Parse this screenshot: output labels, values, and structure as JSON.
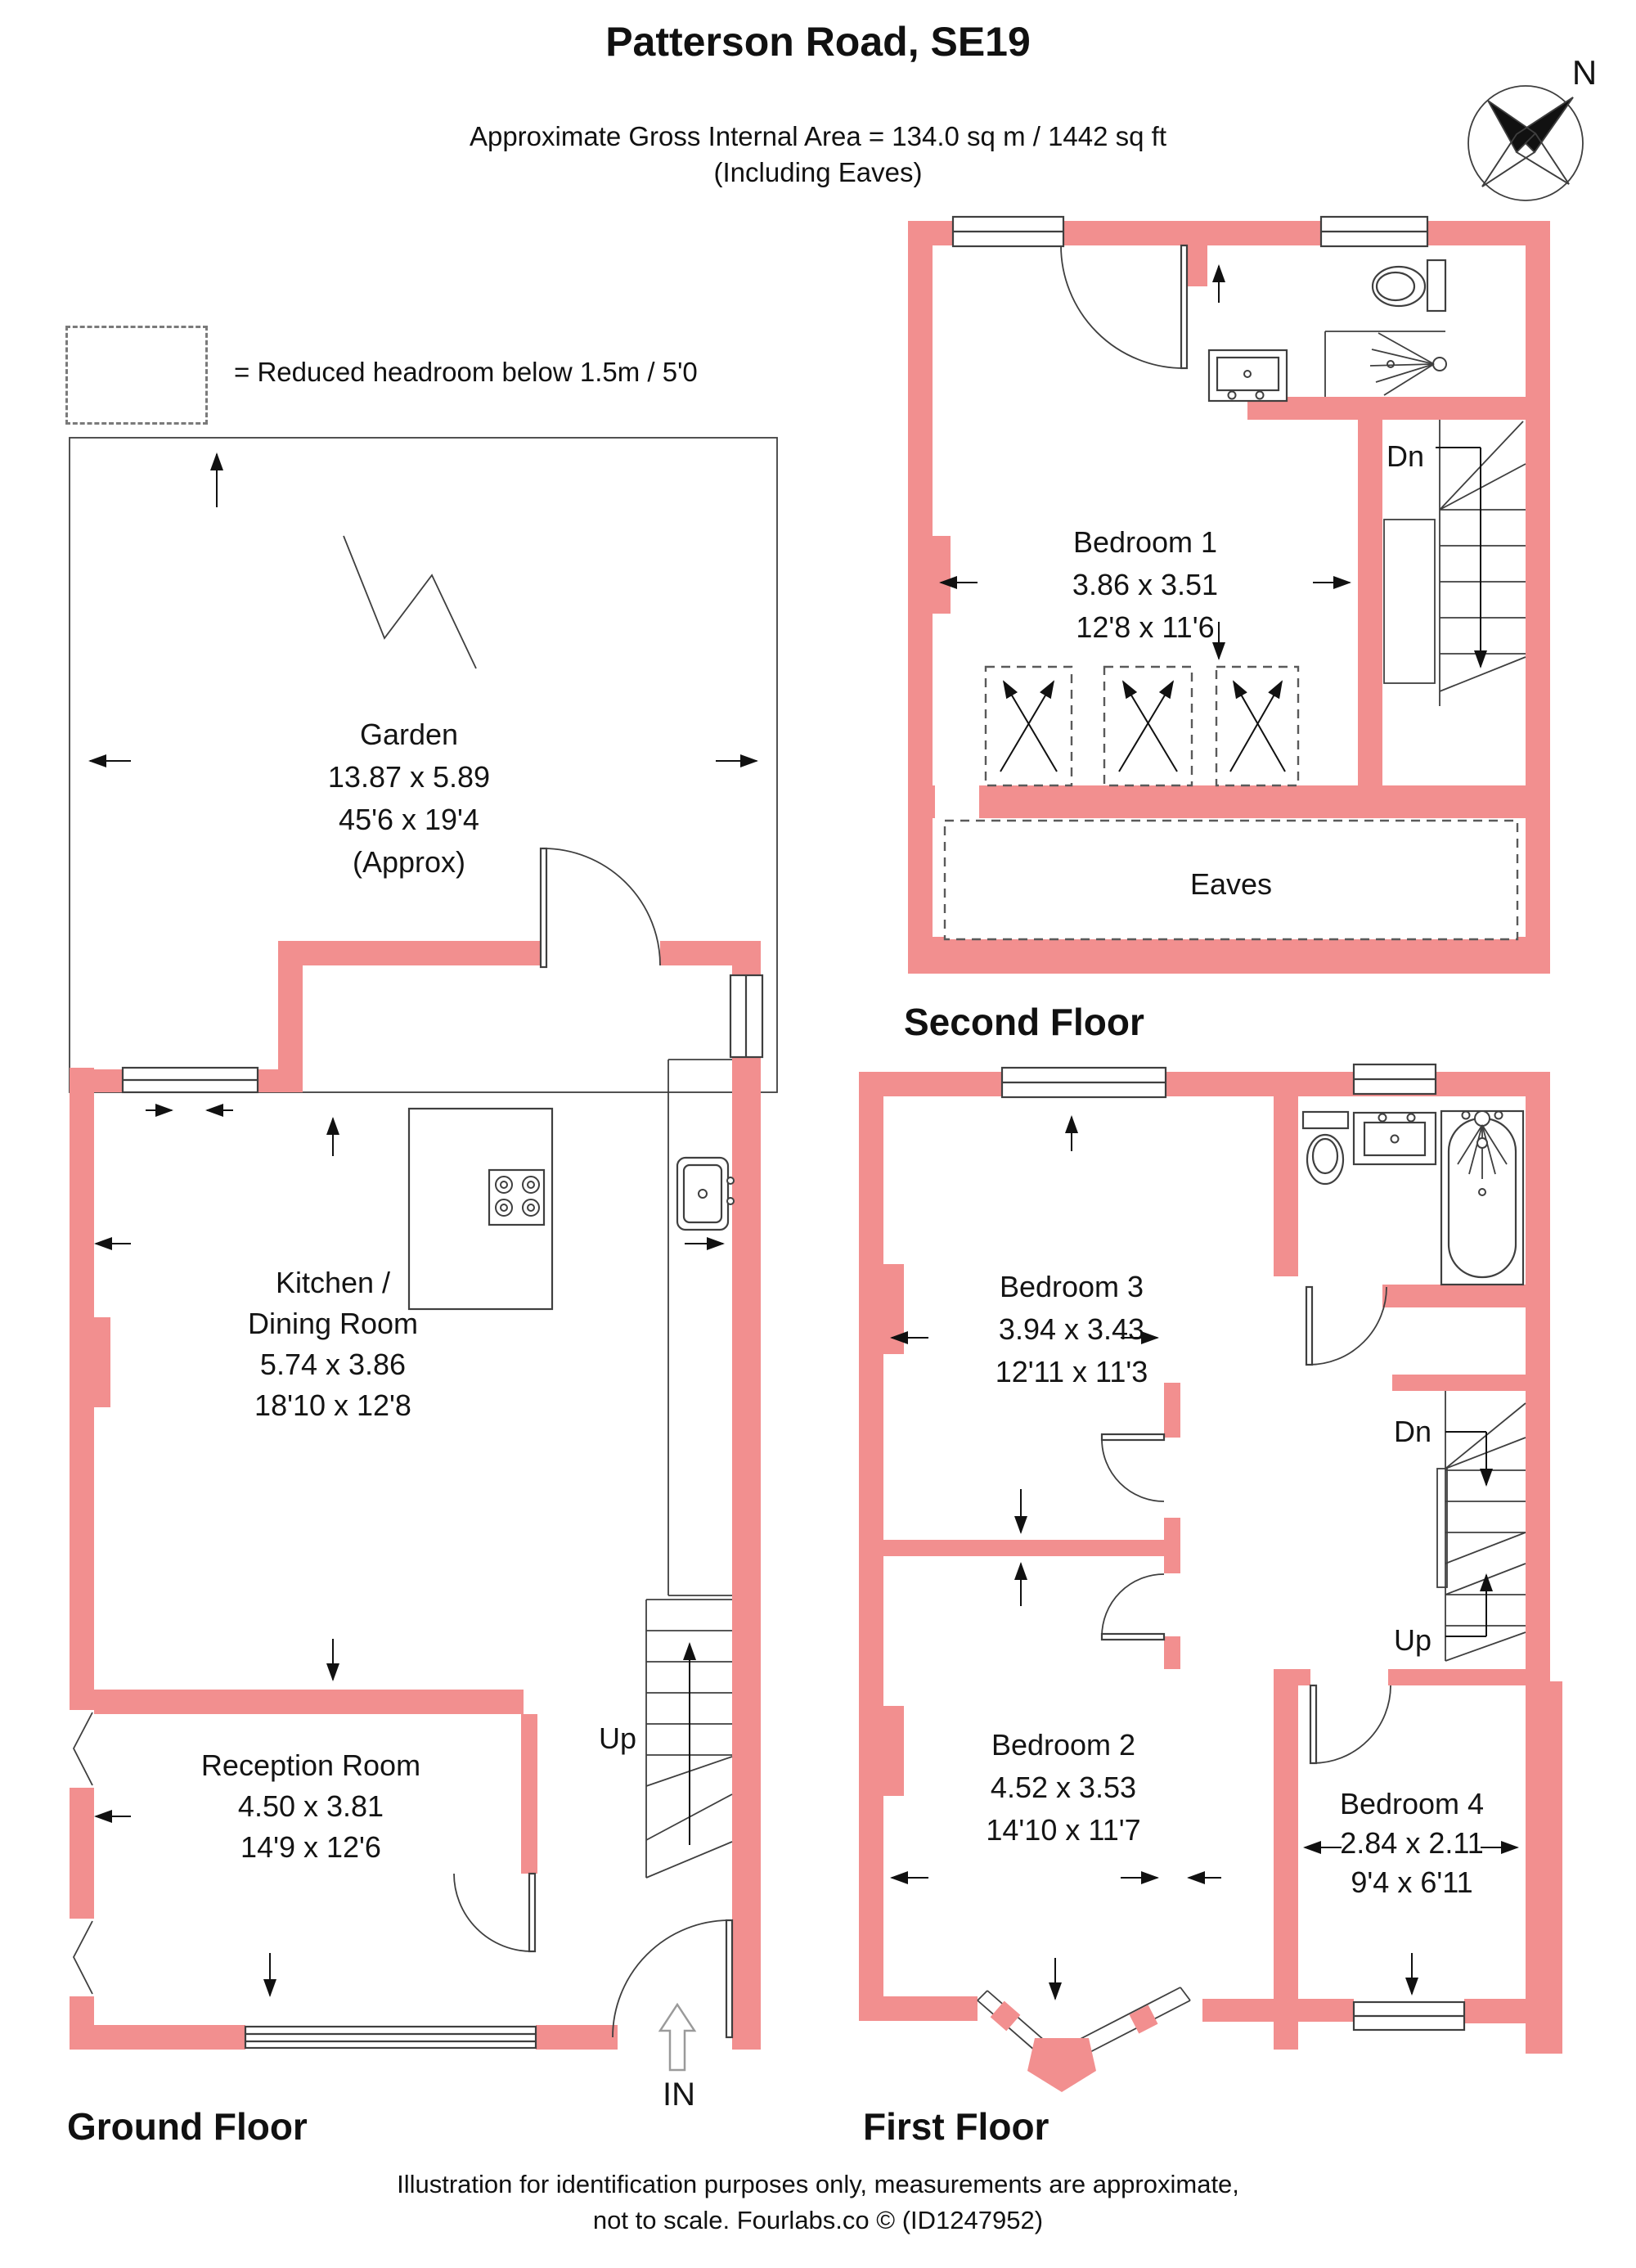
{
  "header": {
    "title": "Patterson Road, SE19",
    "area_line": "Approximate Gross Internal Area = 134.0 sq m / 1442 sq ft",
    "including_line": "(Including Eaves)",
    "compass_n": "N"
  },
  "legend": {
    "label": "= Reduced headroom below 1.5m / 5'0"
  },
  "colors": {
    "wall": "#F28F8F",
    "line": "#3F3F3F"
  },
  "ground_floor": {
    "title": "Ground Floor",
    "garden": {
      "name": "Garden",
      "dim_m": "13.87 x 5.89",
      "dim_ft": "45'6 x 19'4",
      "approx": "(Approx)"
    },
    "kitchen": {
      "name1": "Kitchen /",
      "name2": "Dining Room",
      "dim_m": "5.74 x 3.86",
      "dim_ft": "18'10 x 12'8"
    },
    "reception": {
      "name": "Reception Room",
      "dim_m": "4.50 x 3.81",
      "dim_ft": "14'9 x 12'6"
    },
    "stairs_label": "Up",
    "entrance_label": "IN"
  },
  "second_floor": {
    "title": "Second Floor",
    "bedroom1": {
      "name": "Bedroom 1",
      "dim_m": "3.86 x 3.51",
      "dim_ft": "12'8 x 11'6"
    },
    "stairs_label": "Dn",
    "eaves_label": "Eaves"
  },
  "first_floor": {
    "title": "First Floor",
    "bedroom3": {
      "name": "Bedroom 3",
      "dim_m": "3.94 x 3.43",
      "dim_ft": "12'11 x 11'3"
    },
    "bedroom2": {
      "name": "Bedroom 2",
      "dim_m": "4.52 x 3.53",
      "dim_ft": "14'10 x 11'7"
    },
    "bedroom4": {
      "name": "Bedroom 4",
      "dim_m": "2.84 x 2.11",
      "dim_ft": "9'4 x 6'11"
    },
    "stairs_down_label": "Dn",
    "stairs_up_label": "Up"
  },
  "footer": {
    "line1": "Illustration for identification purposes only, measurements are approximate,",
    "line2": "not to scale. Fourlabs.co © (ID1247952)"
  }
}
